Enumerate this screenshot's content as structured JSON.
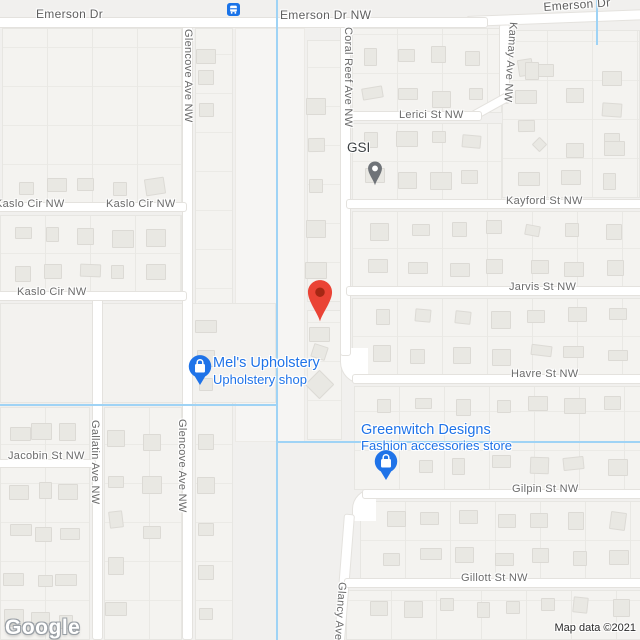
{
  "map": {
    "streets": {
      "emerson_left": "Emerson Dr",
      "emerson_nw": "Emerson Dr NW",
      "emerson_right": "Emerson Dr",
      "glencove": "Glencove Ave NW",
      "coral_reef": "Coral Reef Ave NW",
      "kamay": "Kamay Ave NW",
      "lerici": "Lerici St NW",
      "kayford": "Kayford St NW",
      "kaslo": "Kaslo Cir NW",
      "jarvis": "Jarvis St NW",
      "havre": "Havre St NW",
      "gilpin": "Gilpin St NW",
      "gillott": "Gillott St NW",
      "jacobin": "Jacobin St NW",
      "gallatin": "Gallatin Ave NW",
      "glancy": "Glancy Ave"
    },
    "pois": {
      "gsi": {
        "name": "GSI"
      },
      "mels": {
        "name": "Mel's Upholstery",
        "category": "Upholstery shop"
      },
      "greenwitch": {
        "name": "Greenwitch Designs",
        "category": "Fashion accessories store"
      }
    },
    "markers": {
      "destination": "red-map-pin",
      "transit_stop": "bus-station",
      "gsi": "gray-map-pin",
      "mels": "blue-shopping-pin",
      "greenwitch": "blue-shopping-pin"
    },
    "colors": {
      "poi_blue": "#1f73e8",
      "marker_red": "#ea4335",
      "marker_red_inner": "#a52714",
      "water": "#9fd3f5",
      "street_text": "#6b6b6b"
    },
    "attribution": {
      "logo": "Google",
      "map_data": "Map data ©2021"
    }
  }
}
